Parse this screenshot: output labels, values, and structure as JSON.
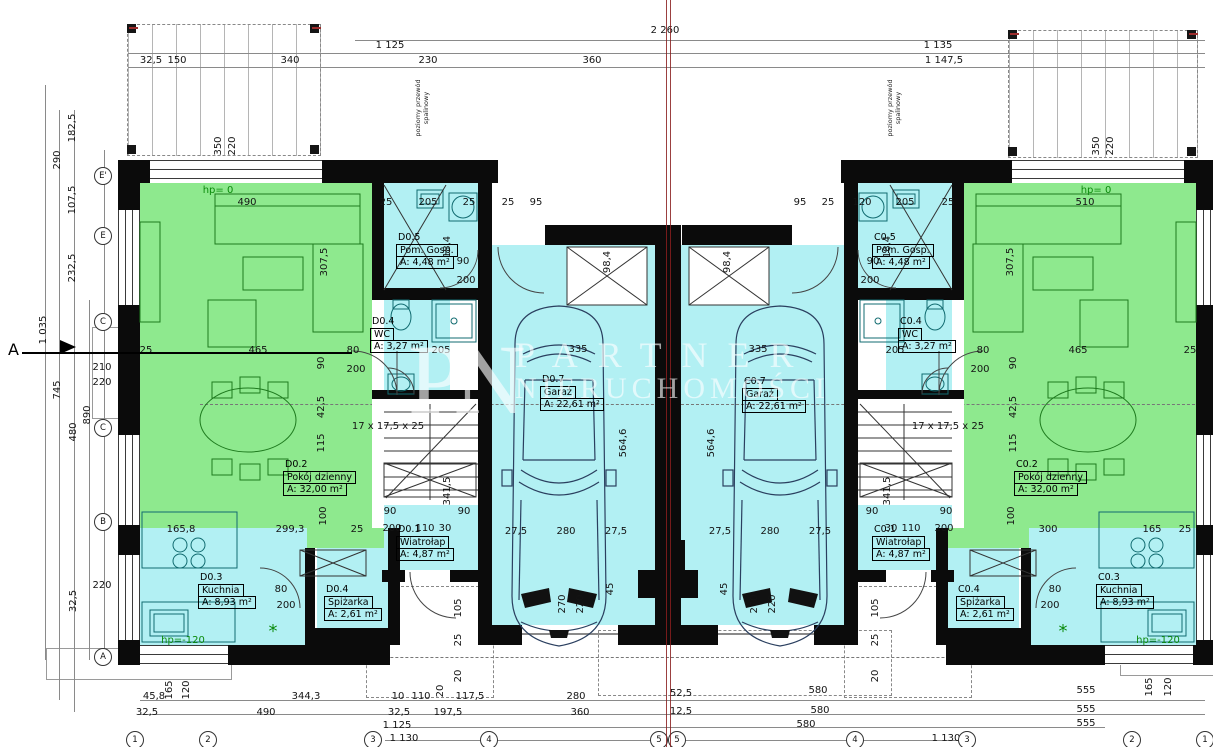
{
  "drawing": {
    "type": "architectural-floor-plan",
    "section_mark": "A",
    "flue_note_line1": "poziomy przewód",
    "flue_note_line2": "spalinowy",
    "watermark": {
      "monogram": "PN",
      "line1": "PARTNER",
      "line2": "NIERUCHOMOŚCI"
    }
  },
  "colors": {
    "room_green": "#8ee98e",
    "room_cyan": "#b2f0f3",
    "wall": "#0b0b0b",
    "axis_red": "#8a1f1f",
    "hp_green": "#0b8a0b"
  },
  "rooms": [
    {
      "code": "D0.5",
      "name": "Pom. Gosp.",
      "area": "A: 4,48 m²",
      "x": 396,
      "y": 232
    },
    {
      "code": "D0.4",
      "name": "WC",
      "area": "A: 3,27 m²",
      "x": 370,
      "y": 316
    },
    {
      "code": "D0.2",
      "name": "Pokój dzienny",
      "area": "A: 32,00 m²",
      "x": 283,
      "y": 459
    },
    {
      "code": "D0.3",
      "name": "Kuchnia",
      "area": "A: 8,93 m²",
      "x": 198,
      "y": 572
    },
    {
      "code": "D0.4",
      "name": "Spiżarka",
      "area": "A: 2,61 m²",
      "x": 324,
      "y": 584
    },
    {
      "code": "D0.1",
      "name": "Wiatrołap",
      "area": "A: 4,87 m²",
      "x": 396,
      "y": 524
    },
    {
      "code": "D0.7",
      "name": "Garaż",
      "area": "A: 22,61 m²",
      "x": 540,
      "y": 374
    },
    {
      "code": "C0.5",
      "name": "Pom. Gosp.",
      "area": "A: 4,48 m²",
      "x": 872,
      "y": 232
    },
    {
      "code": "C0.4",
      "name": "WC",
      "area": "A: 3,27 m²",
      "x": 898,
      "y": 316
    },
    {
      "code": "C0.2",
      "name": "Pokój dzienny",
      "area": "A: 32,00 m²",
      "x": 1014,
      "y": 459
    },
    {
      "code": "C0.3",
      "name": "Kuchnia",
      "area": "A: 8,93 m²",
      "x": 1096,
      "y": 572
    },
    {
      "code": "C0.4",
      "name": "Spiżarka",
      "area": "A: 2,61 m²",
      "x": 956,
      "y": 584
    },
    {
      "code": "C0.1",
      "name": "Wiatrołap",
      "area": "A: 4,87 m²",
      "x": 872,
      "y": 524
    },
    {
      "code": "C0.7",
      "name": "Garaż",
      "area": "A: 22,61 m²",
      "x": 742,
      "y": 376
    }
  ],
  "axes": {
    "left": [
      {
        "l": "E'",
        "y": 176
      },
      {
        "l": "E",
        "y": 236
      },
      {
        "l": "C",
        "y": 322
      },
      {
        "l": "C",
        "y": 428
      },
      {
        "l": "B",
        "y": 522
      },
      {
        "l": "A",
        "y": 657
      }
    ],
    "bottom": [
      {
        "l": "1",
        "x": 135
      },
      {
        "l": "2",
        "x": 208
      },
      {
        "l": "3",
        "x": 373
      },
      {
        "l": "4",
        "x": 489
      },
      {
        "l": "5",
        "x": 659
      },
      {
        "l": "5",
        "x": 677
      },
      {
        "l": "4",
        "x": 855
      },
      {
        "l": "3",
        "x": 967
      },
      {
        "l": "2",
        "x": 1132
      },
      {
        "l": "1",
        "x": 1205
      }
    ]
  },
  "dims": [
    {
      "t": "2 260",
      "x": 665,
      "y": 31
    },
    {
      "t": "1 125",
      "x": 390,
      "y": 46
    },
    {
      "t": "1 135",
      "x": 938,
      "y": 46
    },
    {
      "t": "32,5",
      "x": 151,
      "y": 61
    },
    {
      "t": "150",
      "x": 177,
      "y": 61
    },
    {
      "t": "340",
      "x": 290,
      "y": 61
    },
    {
      "t": "230",
      "x": 428,
      "y": 61
    },
    {
      "t": "360",
      "x": 592,
      "y": 61
    },
    {
      "t": "1 147,5",
      "x": 944,
      "y": 61
    },
    {
      "t": "350",
      "x": 219,
      "y": 146,
      "r": 1
    },
    {
      "t": "220",
      "x": 233,
      "y": 146,
      "r": 1
    },
    {
      "t": "350",
      "x": 1097,
      "y": 146,
      "r": 1
    },
    {
      "t": "220",
      "x": 1111,
      "y": 146,
      "r": 1
    },
    {
      "t": "182,5",
      "x": 73,
      "y": 128,
      "r": 1
    },
    {
      "t": "290",
      "x": 58,
      "y": 160,
      "r": 1
    },
    {
      "t": "107,5",
      "x": 73,
      "y": 200,
      "r": 1
    },
    {
      "t": "232,5",
      "x": 73,
      "y": 268,
      "r": 1
    },
    {
      "t": "1 035",
      "x": 44,
      "y": 330,
      "r": 1
    },
    {
      "t": "745",
      "x": 58,
      "y": 390,
      "r": 1
    },
    {
      "t": "890",
      "x": 88,
      "y": 415,
      "r": 1
    },
    {
      "t": "480",
      "x": 74,
      "y": 432,
      "r": 1
    },
    {
      "t": "210",
      "x": 102,
      "y": 368
    },
    {
      "t": "220",
      "x": 102,
      "y": 383
    },
    {
      "t": "220",
      "x": 102,
      "y": 586
    },
    {
      "t": "32,5",
      "x": 74,
      "y": 601,
      "r": 1
    },
    {
      "t": "hp= 0",
      "x": 218,
      "y": 191,
      "g": 1
    },
    {
      "t": "490",
      "x": 247,
      "y": 203
    },
    {
      "t": "25",
      "x": 386,
      "y": 203
    },
    {
      "t": "205",
      "x": 428,
      "y": 203
    },
    {
      "t": "25",
      "x": 469,
      "y": 203
    },
    {
      "t": "25",
      "x": 508,
      "y": 203
    },
    {
      "t": "95",
      "x": 536,
      "y": 203
    },
    {
      "t": "hp= 0",
      "x": 1096,
      "y": 191,
      "g": 1
    },
    {
      "t": "510",
      "x": 1085,
      "y": 203
    },
    {
      "t": "95",
      "x": 800,
      "y": 203
    },
    {
      "t": "25",
      "x": 828,
      "y": 203
    },
    {
      "t": "120",
      "x": 862,
      "y": 203
    },
    {
      "t": "205",
      "x": 905,
      "y": 203
    },
    {
      "t": "25",
      "x": 948,
      "y": 203
    },
    {
      "t": "90",
      "x": 463,
      "y": 262
    },
    {
      "t": "200",
      "x": 466,
      "y": 281
    },
    {
      "t": "18,4",
      "x": 448,
      "y": 247,
      "r": 1
    },
    {
      "t": "90",
      "x": 873,
      "y": 262
    },
    {
      "t": "200",
      "x": 870,
      "y": 281
    },
    {
      "t": "18,4",
      "x": 888,
      "y": 247,
      "r": 1
    },
    {
      "t": "307,5",
      "x": 325,
      "y": 262,
      "r": 1
    },
    {
      "t": "307,5",
      "x": 1011,
      "y": 262,
      "r": 1
    },
    {
      "t": "25",
      "x": 146,
      "y": 351
    },
    {
      "t": "465",
      "x": 258,
      "y": 351
    },
    {
      "t": "80",
      "x": 353,
      "y": 351
    },
    {
      "t": "205",
      "x": 441,
      "y": 351
    },
    {
      "t": "90",
      "x": 322,
      "y": 363,
      "r": 1
    },
    {
      "t": "200",
      "x": 356,
      "y": 370
    },
    {
      "t": "25",
      "x": 1190,
      "y": 351
    },
    {
      "t": "465",
      "x": 1078,
      "y": 351
    },
    {
      "t": "80",
      "x": 983,
      "y": 351
    },
    {
      "t": "205",
      "x": 895,
      "y": 351
    },
    {
      "t": "90",
      "x": 1014,
      "y": 363,
      "r": 1
    },
    {
      "t": "200",
      "x": 980,
      "y": 370
    },
    {
      "t": "335",
      "x": 578,
      "y": 350
    },
    {
      "t": "335",
      "x": 758,
      "y": 350
    },
    {
      "t": "98,4",
      "x": 608,
      "y": 262,
      "r": 1
    },
    {
      "t": "98,4",
      "x": 728,
      "y": 262,
      "r": 1
    },
    {
      "t": "564,6",
      "x": 624,
      "y": 443,
      "r": 1
    },
    {
      "t": "564,6",
      "x": 712,
      "y": 443,
      "r": 1
    },
    {
      "t": "27,5",
      "x": 516,
      "y": 532
    },
    {
      "t": "280",
      "x": 566,
      "y": 532
    },
    {
      "t": "27,5",
      "x": 616,
      "y": 532
    },
    {
      "t": "27,5",
      "x": 720,
      "y": 532
    },
    {
      "t": "280",
      "x": 770,
      "y": 532
    },
    {
      "t": "27,5",
      "x": 820,
      "y": 532
    },
    {
      "t": "270",
      "x": 563,
      "y": 604,
      "r": 1
    },
    {
      "t": "220",
      "x": 581,
      "y": 604,
      "r": 1
    },
    {
      "t": "270",
      "x": 755,
      "y": 604,
      "r": 1
    },
    {
      "t": "220",
      "x": 773,
      "y": 604,
      "r": 1
    },
    {
      "t": "45",
      "x": 611,
      "y": 589,
      "r": 1
    },
    {
      "t": "45",
      "x": 725,
      "y": 589,
      "r": 1
    },
    {
      "t": "17 x 17,5 x 25",
      "x": 388,
      "y": 427
    },
    {
      "t": "17 x 17,5 x 25",
      "x": 948,
      "y": 427
    },
    {
      "t": "42,5",
      "x": 322,
      "y": 407,
      "r": 1
    },
    {
      "t": "115",
      "x": 322,
      "y": 443,
      "r": 1
    },
    {
      "t": "42,5",
      "x": 1014,
      "y": 407,
      "r": 1
    },
    {
      "t": "115",
      "x": 1014,
      "y": 443,
      "r": 1
    },
    {
      "t": "90",
      "x": 390,
      "y": 512
    },
    {
      "t": "90",
      "x": 464,
      "y": 512
    },
    {
      "t": "341,5",
      "x": 448,
      "y": 491,
      "r": 1
    },
    {
      "t": "100",
      "x": 324,
      "y": 516,
      "r": 1
    },
    {
      "t": "165,8",
      "x": 181,
      "y": 530
    },
    {
      "t": "299,3",
      "x": 290,
      "y": 530
    },
    {
      "t": "25",
      "x": 357,
      "y": 530
    },
    {
      "t": "200",
      "x": 392,
      "y": 529
    },
    {
      "t": "110",
      "x": 425,
      "y": 529
    },
    {
      "t": "30",
      "x": 445,
      "y": 529
    },
    {
      "t": "90",
      "x": 872,
      "y": 512
    },
    {
      "t": "90",
      "x": 946,
      "y": 512
    },
    {
      "t": "341,5",
      "x": 888,
      "y": 491,
      "r": 1
    },
    {
      "t": "100",
      "x": 1012,
      "y": 516,
      "r": 1
    },
    {
      "t": "300",
      "x": 1048,
      "y": 530
    },
    {
      "t": "165",
      "x": 1152,
      "y": 530
    },
    {
      "t": "25",
      "x": 1185,
      "y": 530
    },
    {
      "t": "200",
      "x": 944,
      "y": 529
    },
    {
      "t": "110",
      "x": 911,
      "y": 529
    },
    {
      "t": "30",
      "x": 891,
      "y": 529
    },
    {
      "t": "80",
      "x": 281,
      "y": 590
    },
    {
      "t": "200",
      "x": 286,
      "y": 606
    },
    {
      "t": "80",
      "x": 1055,
      "y": 590
    },
    {
      "t": "200",
      "x": 1050,
      "y": 606
    },
    {
      "t": "*",
      "x": 273,
      "y": 632,
      "g": 1,
      "fs": 18
    },
    {
      "t": "*",
      "x": 1063,
      "y": 632,
      "g": 1,
      "fs": 18
    },
    {
      "t": "hp=-120",
      "x": 183,
      "y": 641,
      "g": 1
    },
    {
      "t": "hp=-120",
      "x": 1158,
      "y": 641,
      "g": 1
    },
    {
      "t": "105",
      "x": 459,
      "y": 608,
      "r": 1
    },
    {
      "t": "25",
      "x": 459,
      "y": 640,
      "r": 1
    },
    {
      "t": "20",
      "x": 459,
      "y": 676,
      "r": 1
    },
    {
      "t": "105",
      "x": 876,
      "y": 608,
      "r": 1
    },
    {
      "t": "25",
      "x": 876,
      "y": 640,
      "r": 1
    },
    {
      "t": "20",
      "x": 876,
      "y": 676,
      "r": 1
    },
    {
      "t": "45,8",
      "x": 154,
      "y": 697
    },
    {
      "t": "165",
      "x": 170,
      "y": 690,
      "r": 1
    },
    {
      "t": "120",
      "x": 187,
      "y": 690,
      "r": 1
    },
    {
      "t": "344,3",
      "x": 306,
      "y": 697
    },
    {
      "t": "10",
      "x": 398,
      "y": 697
    },
    {
      "t": "110",
      "x": 421,
      "y": 697
    },
    {
      "t": "20",
      "x": 441,
      "y": 691,
      "r": 1
    },
    {
      "t": "117,5",
      "x": 470,
      "y": 697
    },
    {
      "t": "280",
      "x": 576,
      "y": 697
    },
    {
      "t": "52,5",
      "x": 681,
      "y": 694
    },
    {
      "t": "580",
      "x": 818,
      "y": 691
    },
    {
      "t": "555",
      "x": 1086,
      "y": 691
    },
    {
      "t": "165",
      "x": 1150,
      "y": 687,
      "r": 1
    },
    {
      "t": "120",
      "x": 1169,
      "y": 687,
      "r": 1
    },
    {
      "t": "32,5",
      "x": 147,
      "y": 713
    },
    {
      "t": "490",
      "x": 266,
      "y": 713
    },
    {
      "t": "32,5",
      "x": 399,
      "y": 713
    },
    {
      "t": "197,5",
      "x": 448,
      "y": 713
    },
    {
      "t": "360",
      "x": 580,
      "y": 713
    },
    {
      "t": "12,5",
      "x": 681,
      "y": 712
    },
    {
      "t": "580",
      "x": 820,
      "y": 711
    },
    {
      "t": "555",
      "x": 1086,
      "y": 710
    },
    {
      "t": "1 125",
      "x": 397,
      "y": 726
    },
    {
      "t": "580",
      "x": 806,
      "y": 725
    },
    {
      "t": "555",
      "x": 1086,
      "y": 724
    },
    {
      "t": "1 130",
      "x": 404,
      "y": 739
    },
    {
      "t": "1 130",
      "x": 946,
      "y": 739
    }
  ]
}
